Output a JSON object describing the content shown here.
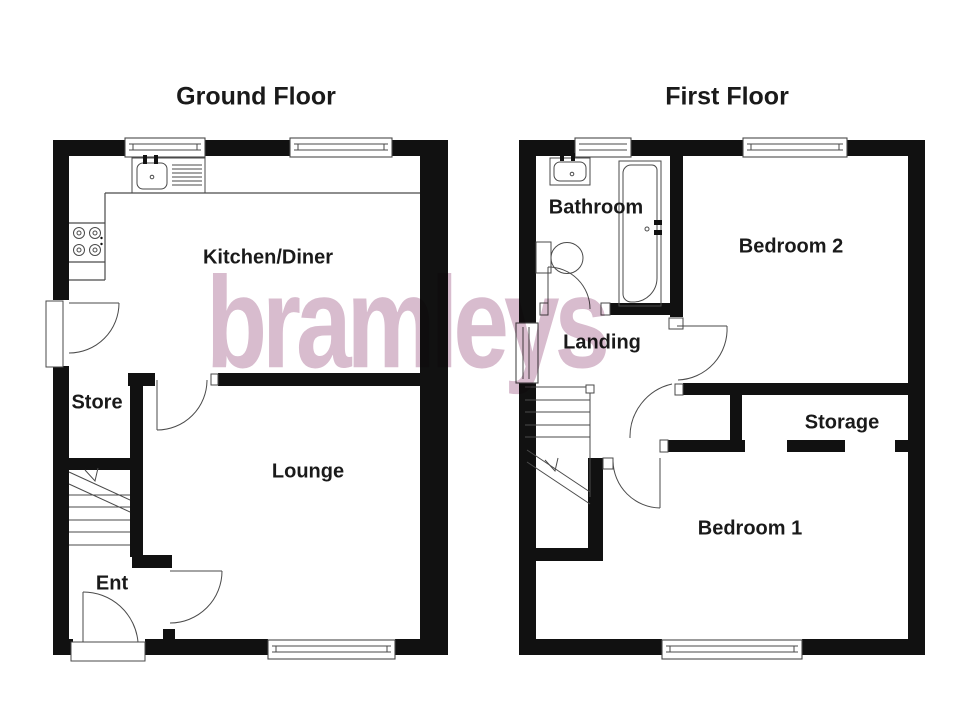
{
  "watermark": {
    "text": "bramleys",
    "color": "#d8bcce"
  },
  "ground_floor": {
    "title": "Ground Floor",
    "rooms": {
      "kitchen": "Kitchen/Diner",
      "store": "Store",
      "lounge": "Lounge",
      "entrance": "Ent"
    },
    "fixtures": [
      "kitchen-sink",
      "drainer",
      "hob",
      "stairs",
      "side-door",
      "front-door"
    ]
  },
  "first_floor": {
    "title": "First Floor",
    "rooms": {
      "bathroom": "Bathroom",
      "bedroom2": "Bedroom 2",
      "landing": "Landing",
      "storage": "Storage",
      "bedroom1": "Bedroom 1"
    },
    "fixtures": [
      "wash-basin",
      "toilet",
      "bath",
      "stairs",
      "storage-opening"
    ]
  },
  "colors": {
    "wall": "#111111",
    "line": "#4a4a4a",
    "label": "#1a1a1a",
    "watermark": "#d8bcce"
  }
}
